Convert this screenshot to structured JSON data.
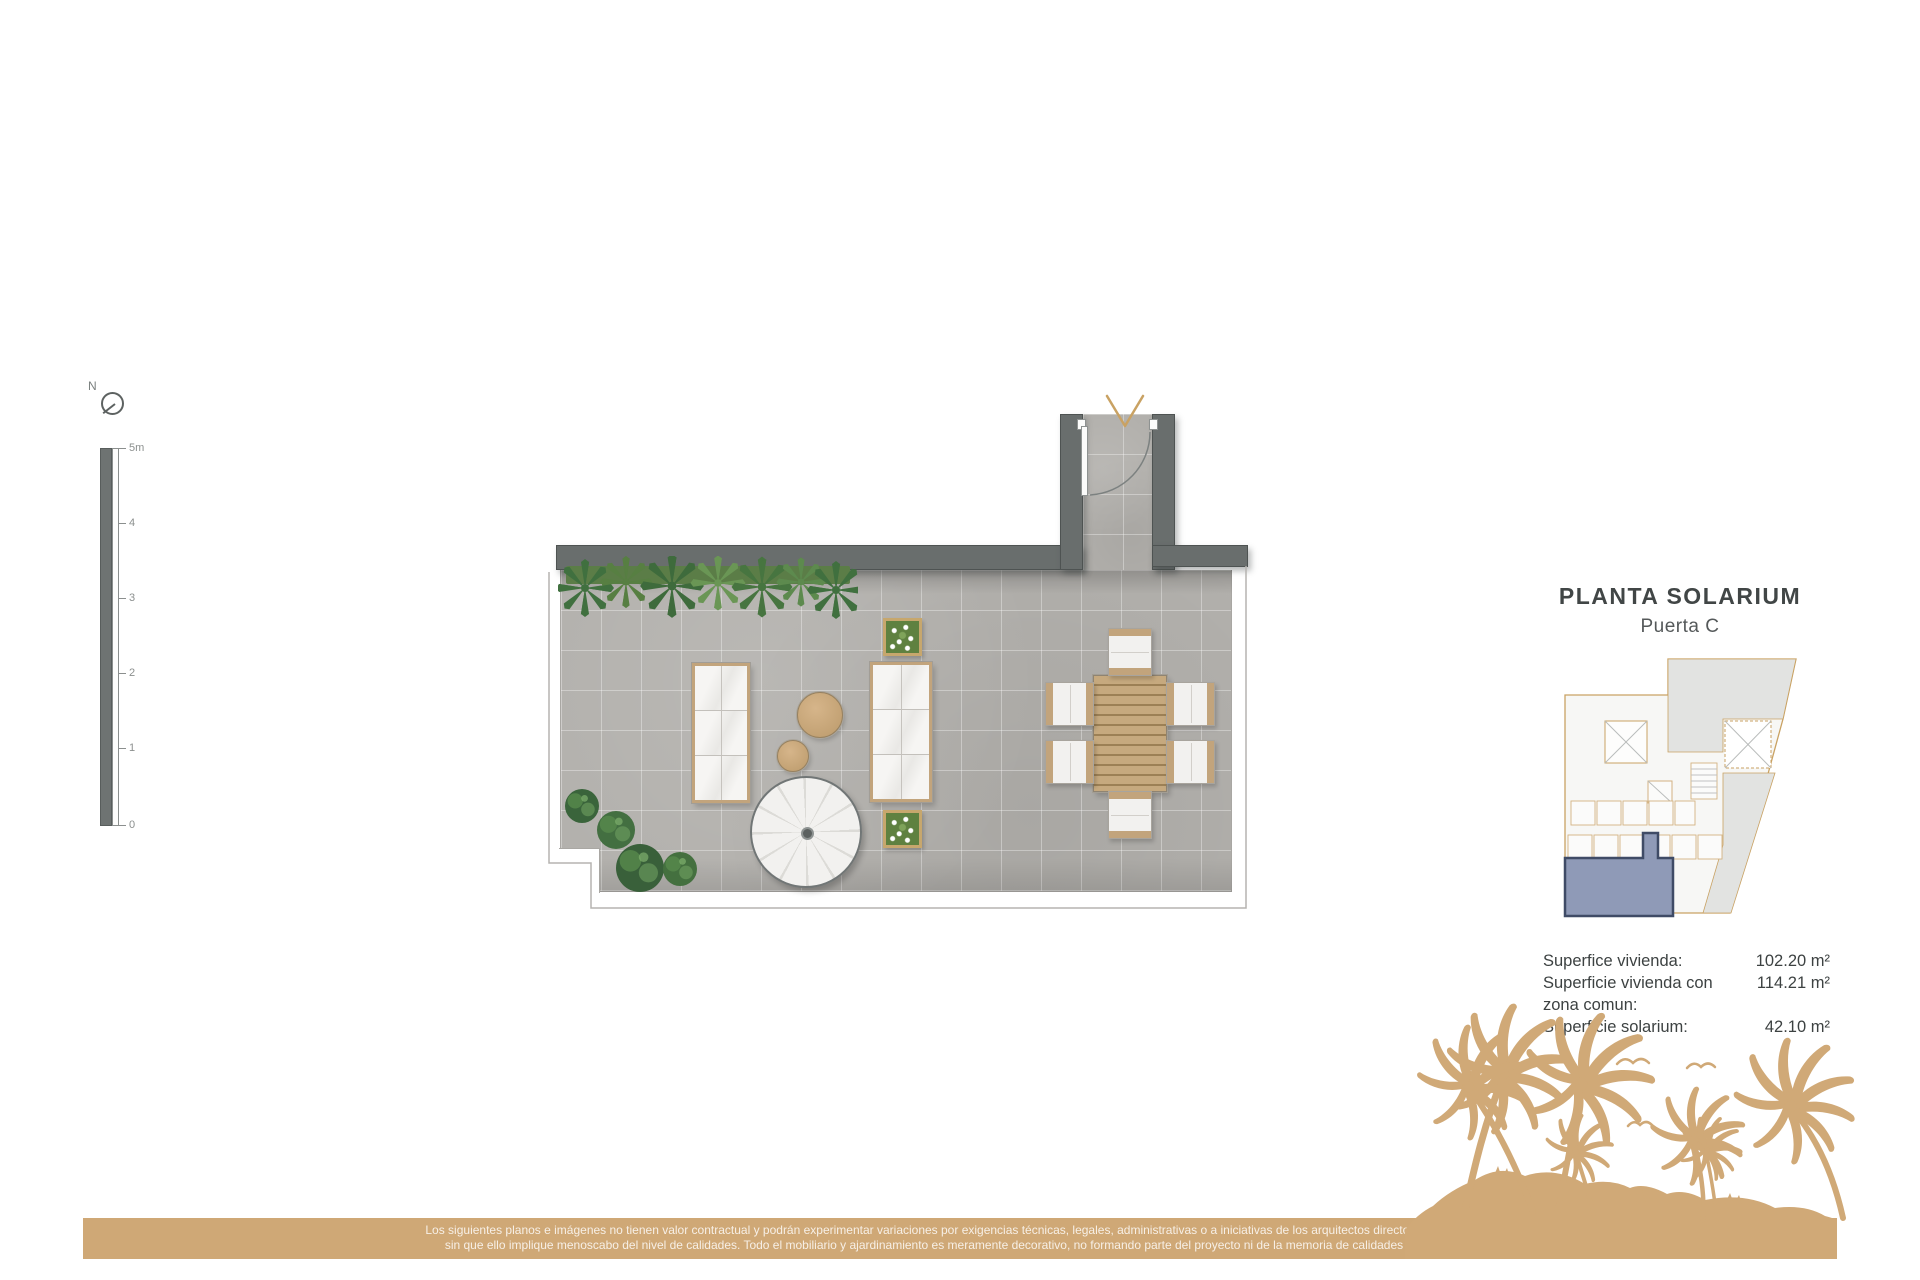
{
  "header": {
    "title": "PLANTA SOLARIUM",
    "subtitle": "Puerta C"
  },
  "areas": {
    "rows": [
      {
        "label": "Superfice vivienda:",
        "value": "102.20 m²"
      },
      {
        "label": "Superficie vivienda con",
        "value": "114.21 m²"
      },
      {
        "label": "zona comun:",
        "value": ""
      },
      {
        "label": "Superficie solarium:",
        "value": "42.10 m²"
      }
    ]
  },
  "scalebar": {
    "labels": [
      "5m",
      "4",
      "3",
      "2",
      "1",
      "0"
    ]
  },
  "compass": {
    "label": "N"
  },
  "disclaimer": {
    "line1": "Los siguientes planos e imágenes no tienen valor contractual y podrán experimentar variaciones por exigencias técnicas, legales, administrativas o a iniciativas de los arquitectos directores de las obras",
    "line2": "sin que ello implique menoscabo del nivel de calidades. Todo el mobiliario y ajardinamiento es meramente decorativo, no formando parte del proyecto ni de la memoria de calidades del proyecto."
  },
  "colors": {
    "accent_gold": "#c9a263",
    "banner_tan": "#cfa876",
    "wall_gray": "#696e6d",
    "floor_gray": "#b2b0ac",
    "highlight_unit_blue": "#8f9ab7"
  }
}
